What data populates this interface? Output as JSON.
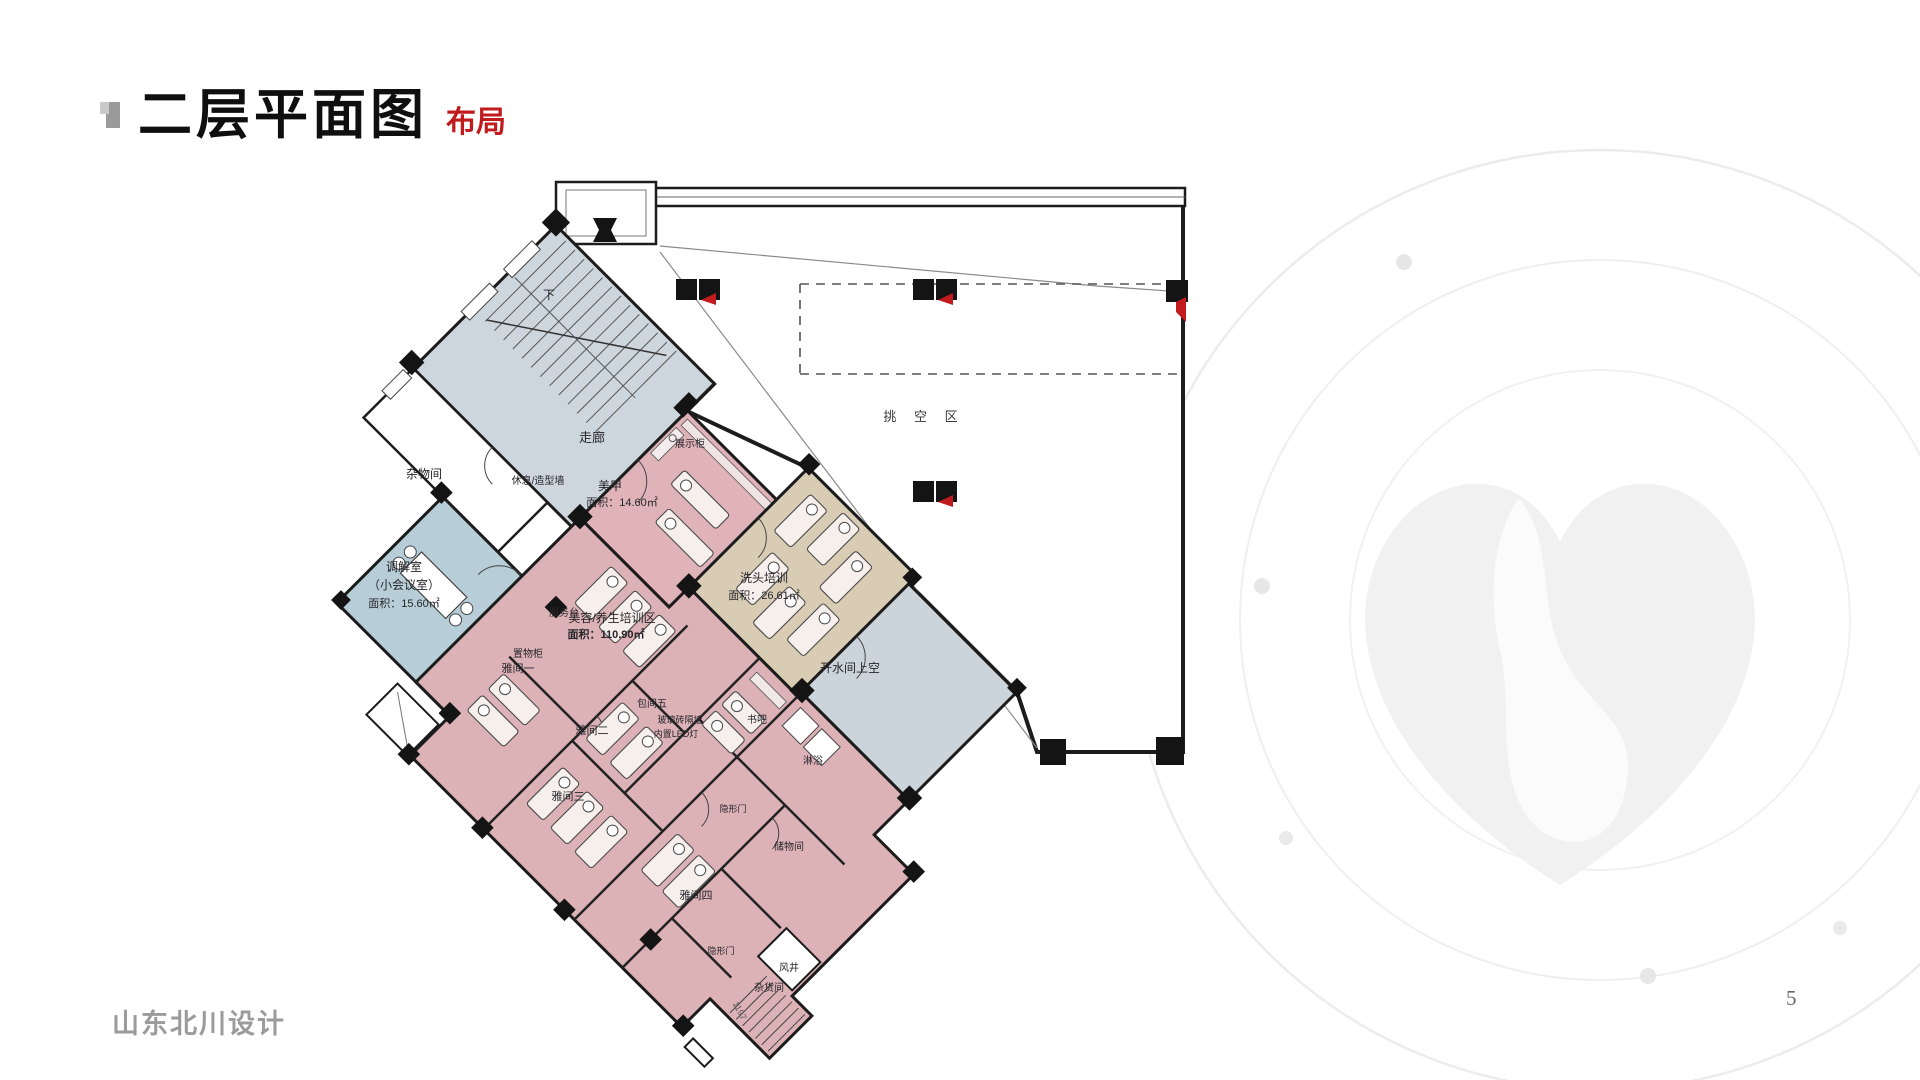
{
  "slide": {
    "title": "二层平面图",
    "subtitle": "布局",
    "footer": "山东北川设计",
    "page_number": "5"
  },
  "colors": {
    "accent_red": "#c11b1e",
    "wall_dark": "#1c1c1c",
    "room_gray": "#ced6dd",
    "room_blue": "#b7cdd7",
    "room_pink": "#dcb2b7",
    "room_pink_light": "#dfb3b8",
    "room_beige": "#d8ccb4",
    "watermark_gray": "#ededed"
  },
  "plan": {
    "labels": [
      {
        "id": "stair-down",
        "text": "下",
        "x": 549,
        "y": 299,
        "s": 12
      },
      {
        "id": "corridor",
        "text": "走廊",
        "x": 592,
        "y": 442,
        "s": 13
      },
      {
        "id": "storage-room",
        "text": "杂物间",
        "x": 424,
        "y": 478,
        "s": 12
      },
      {
        "id": "rest-styling-wall",
        "text": "休息/造型墙",
        "x": 538,
        "y": 484,
        "s": 10
      },
      {
        "id": "display-cabinet",
        "text": "展示柜",
        "x": 690,
        "y": 447,
        "s": 10
      },
      {
        "id": "nail-room",
        "text": "美甲",
        "x": 610,
        "y": 490,
        "s": 12
      },
      {
        "id": "nail-room-area",
        "text": "面积：14.60㎡",
        "x": 622,
        "y": 506,
        "s": 11
      },
      {
        "id": "hair-wash-training",
        "text": "洗头培训",
        "x": 764,
        "y": 582,
        "s": 12
      },
      {
        "id": "hair-wash-area",
        "text": "面积：26.61㎡",
        "x": 764,
        "y": 599,
        "s": 11
      },
      {
        "id": "mediation-room",
        "text": "调解室",
        "x": 404,
        "y": 571,
        "s": 12
      },
      {
        "id": "small-meeting-room",
        "text": "（小会议室）",
        "x": 404,
        "y": 589,
        "s": 12
      },
      {
        "id": "mediation-area",
        "text": "面积：15.60㎡",
        "x": 404,
        "y": 607,
        "s": 11
      },
      {
        "id": "service-desk",
        "text": "服务台",
        "x": 564,
        "y": 616,
        "s": 10
      },
      {
        "id": "storage-cabinet",
        "text": "置物柜",
        "x": 528,
        "y": 657,
        "s": 10
      },
      {
        "id": "private-room-1",
        "text": "雅间一",
        "x": 518,
        "y": 672,
        "s": 11
      },
      {
        "id": "beauty-training-zone",
        "text": "美容/养生培训区",
        "x": 612,
        "y": 622,
        "s": 12
      },
      {
        "id": "beauty-training-area",
        "text": "面积：110.90㎡",
        "x": 606,
        "y": 638,
        "s": 11,
        "b": true
      },
      {
        "id": "private-room-5",
        "text": "包间五",
        "x": 652,
        "y": 707,
        "s": 10
      },
      {
        "id": "glass-brick-wall",
        "text": "玻璃砖隔墙",
        "x": 680,
        "y": 723,
        "s": 9
      },
      {
        "id": "led-light",
        "text": "内置LED灯",
        "x": 676,
        "y": 737,
        "s": 9
      },
      {
        "id": "private-room-2",
        "text": "雅间二",
        "x": 592,
        "y": 734,
        "s": 11
      },
      {
        "id": "book-bar",
        "text": "书吧",
        "x": 757,
        "y": 723,
        "s": 10
      },
      {
        "id": "shower",
        "text": "淋浴",
        "x": 813,
        "y": 764,
        "s": 10
      },
      {
        "id": "water-room-void",
        "text": "开水间上空",
        "x": 850,
        "y": 672,
        "s": 12
      },
      {
        "id": "private-room-3",
        "text": "雅间三",
        "x": 568,
        "y": 800,
        "s": 11
      },
      {
        "id": "hidden-door-1",
        "text": "隐形门",
        "x": 733,
        "y": 812,
        "s": 9
      },
      {
        "id": "storeroom",
        "text": "储物间",
        "x": 789,
        "y": 850,
        "s": 10
      },
      {
        "id": "private-room-4",
        "text": "雅间四",
        "x": 696,
        "y": 899,
        "s": 11
      },
      {
        "id": "hidden-door-2",
        "text": "隐形门",
        "x": 721,
        "y": 954,
        "s": 9
      },
      {
        "id": "air-shaft",
        "text": "风井",
        "x": 789,
        "y": 971,
        "s": 10
      },
      {
        "id": "sundry-room",
        "text": "杂货间",
        "x": 769,
        "y": 991,
        "s": 10
      },
      {
        "id": "void-area",
        "text": "挑  空  区",
        "x": 924,
        "y": 421,
        "s": 13,
        "ls": 7,
        "c": "#3a3a3a"
      },
      {
        "id": "level-dim",
        "text": "1197",
        "x": 737,
        "y": 1012,
        "s": 9,
        "rot": 62,
        "c": "#555555"
      }
    ]
  }
}
